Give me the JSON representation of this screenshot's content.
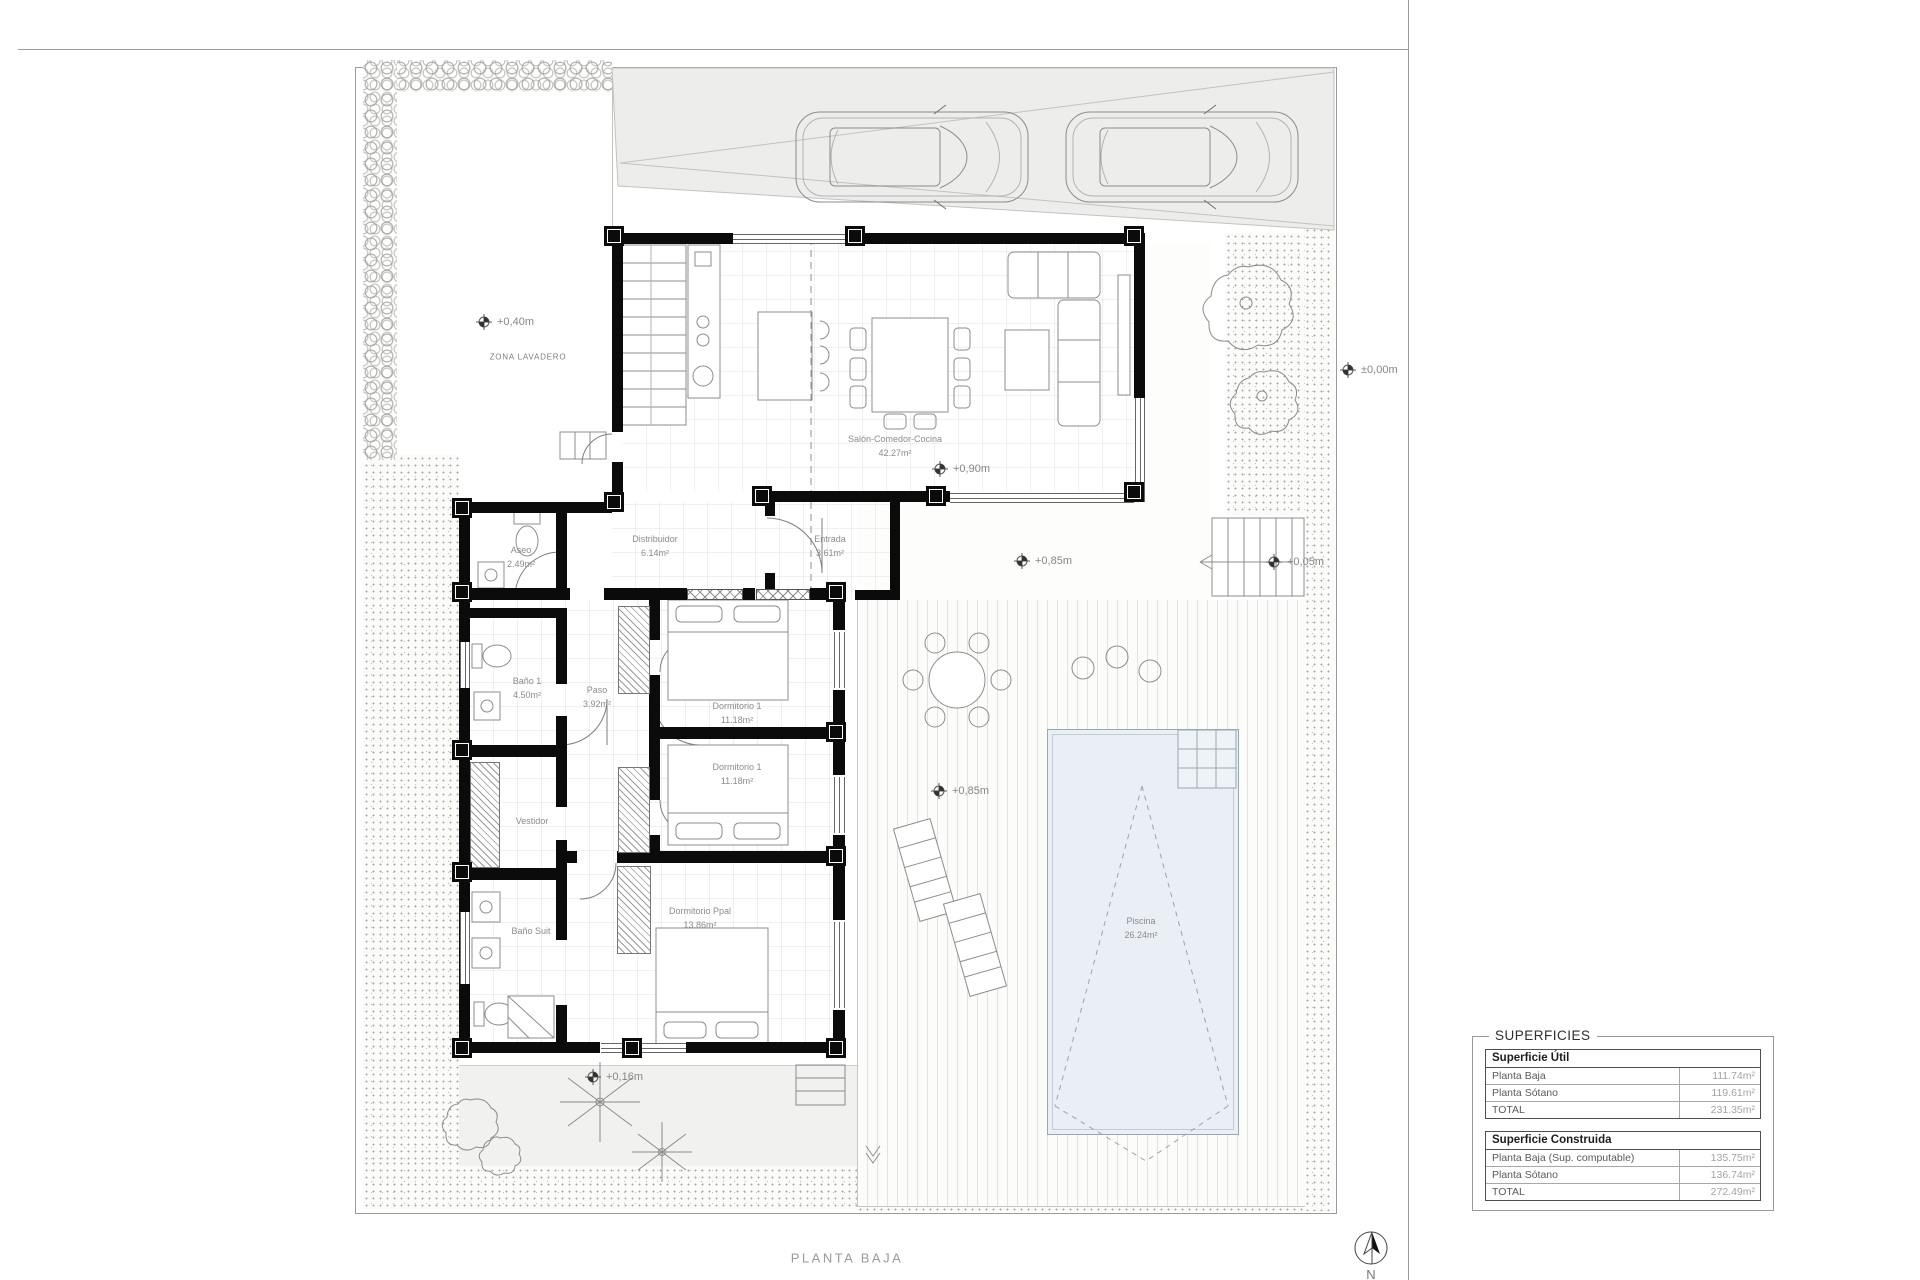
{
  "meta": {
    "sheet_title": "PLANTA BAJA",
    "north_label": "N"
  },
  "site": {
    "zona_lavadero": "ZONA LAVADERO",
    "levels": [
      {
        "id": "lavadero",
        "label": "+0,40m"
      },
      {
        "id": "salon",
        "label": "+0,90m"
      },
      {
        "id": "porche",
        "label": "+0,85m"
      },
      {
        "id": "escalera",
        "label": "+0,05m"
      },
      {
        "id": "calle",
        "label": "±0,00m"
      },
      {
        "id": "terraza",
        "label": "+0,85m"
      },
      {
        "id": "jardin",
        "label": "+0,16m"
      }
    ]
  },
  "rooms": [
    {
      "name": "Salón-Comedor-Cocina",
      "area": "42.27m²"
    },
    {
      "name": "Distribuidor",
      "area": "6.14m²"
    },
    {
      "name": "Entrada",
      "area": "3.61m²"
    },
    {
      "name": "Aseo",
      "area": "2.49m²"
    },
    {
      "name": "Baño 1",
      "area": "4.50m²"
    },
    {
      "name": "Paso",
      "area": "3.92m²"
    },
    {
      "name": "Dormitorio 1",
      "area": "11.18m²"
    },
    {
      "name": "Dormitorio 1",
      "area": "11.18m²"
    },
    {
      "name": "Vestidor",
      "area": ""
    },
    {
      "name": "Baño Suit",
      "area": ""
    },
    {
      "name": "Dormitorio Ppal",
      "area": "13.86m²"
    },
    {
      "name": "Piscina",
      "area": "26.24m²"
    }
  ],
  "areas_table": {
    "title": "SUPERFICIES",
    "sections": [
      {
        "header": "Superficie Útil",
        "rows": [
          [
            "Planta Baja",
            "111.74m²"
          ],
          [
            "Planta Sótano",
            "119.61m²"
          ],
          [
            "TOTAL",
            "231.35m²"
          ]
        ]
      },
      {
        "header": "Superficie Construida",
        "rows": [
          [
            "Planta Baja (Sup. computable)",
            "135.75m²"
          ],
          [
            "Planta Sótano",
            "136.74m²"
          ],
          [
            "TOTAL",
            "272.49m²"
          ]
        ]
      }
    ]
  }
}
